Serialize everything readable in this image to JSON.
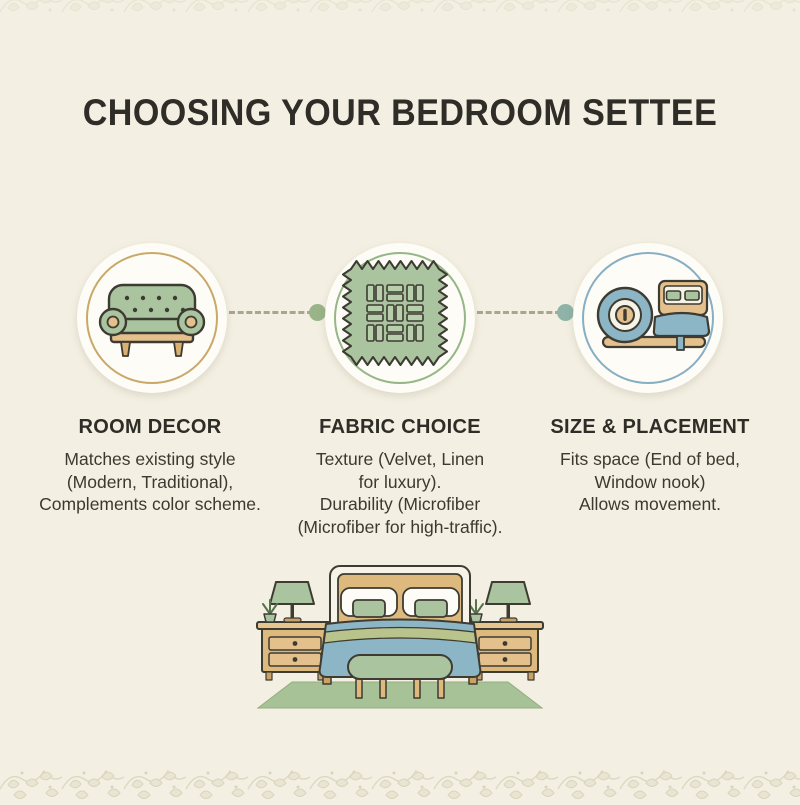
{
  "title": "CHOOSING YOUR BEDROOM SETTEE",
  "palette": {
    "background": "#f3efe2",
    "ring_gold": "#c9a869",
    "ring_green": "#95b686",
    "ring_blue": "#87aec3",
    "sage": "#a9c49e",
    "blue": "#8cb5c6",
    "tan": "#ddb97e",
    "outline": "#3d3b32",
    "connector_dash": "#aaa58f",
    "connector_dot_green": "#9ab388",
    "connector_dot_teal": "#8fb3a6"
  },
  "steps": [
    {
      "heading": "ROOM DECOR",
      "lines": [
        "Matches existing style",
        "(Modern, Traditional),",
        "Complements color scheme."
      ],
      "icon": "settee-icon",
      "ring_color": "#c9a869"
    },
    {
      "heading": "FABRIC CHOICE",
      "lines": [
        "Texture (Velvet, Linen",
        "for luxury).",
        "Durability (Microfiber",
        "(Microfiber for high-traffic)."
      ],
      "icon": "fabric-swatch-icon",
      "ring_color": "#95b686"
    },
    {
      "heading": "SIZE & PLACEMENT",
      "lines": [
        "Fits space (End of bed,",
        "Window nook)",
        "Allows movement."
      ],
      "icon": "measuring-tape-bed-icon",
      "ring_color": "#87aec3"
    }
  ],
  "illustration": {
    "name": "bedroom-scene",
    "elements": [
      "bed",
      "pillows",
      "blanket",
      "settee-bench",
      "nightstand-left",
      "nightstand-right",
      "lamps",
      "plants",
      "rug"
    ]
  },
  "decor": {
    "border": "leaf-vine-border"
  }
}
